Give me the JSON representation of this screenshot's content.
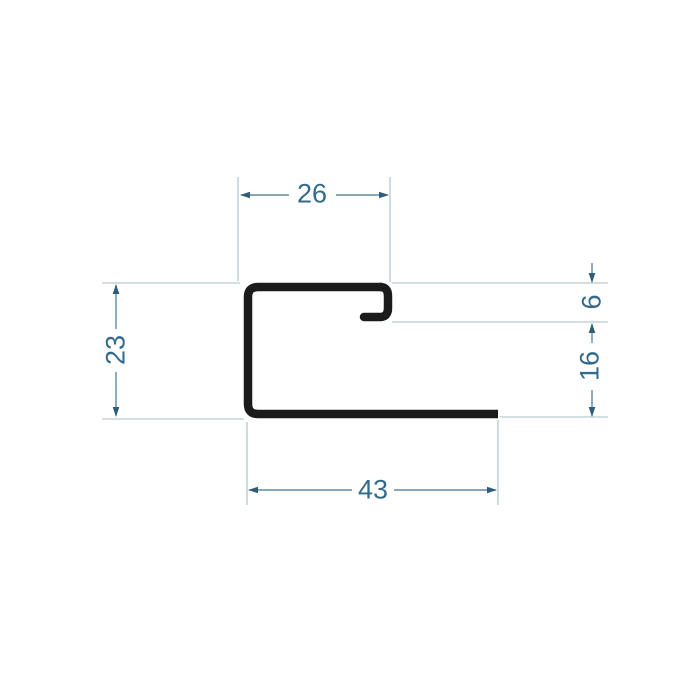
{
  "diagram": {
    "type": "technical-profile-cross-section",
    "description": "J-trim metal profile cross section with dimension annotations",
    "dimensions": {
      "top_width": {
        "value": "26",
        "orientation": "horizontal",
        "location": "top"
      },
      "left_height": {
        "value": "23",
        "orientation": "vertical",
        "location": "left"
      },
      "hook_height": {
        "value": "6",
        "orientation": "vertical",
        "location": "right-upper"
      },
      "right_lower_height": {
        "value": "16",
        "orientation": "vertical",
        "location": "right-lower"
      },
      "bottom_width": {
        "value": "43",
        "orientation": "horizontal",
        "location": "bottom"
      }
    },
    "colors": {
      "profile": "#1b1b1b",
      "dimension_line": "#44758f",
      "dimension_text": "#336a8c",
      "extension_line": "#a6bec9",
      "arrowhead": "#2e5d7a",
      "background": "#ffffff"
    }
  }
}
